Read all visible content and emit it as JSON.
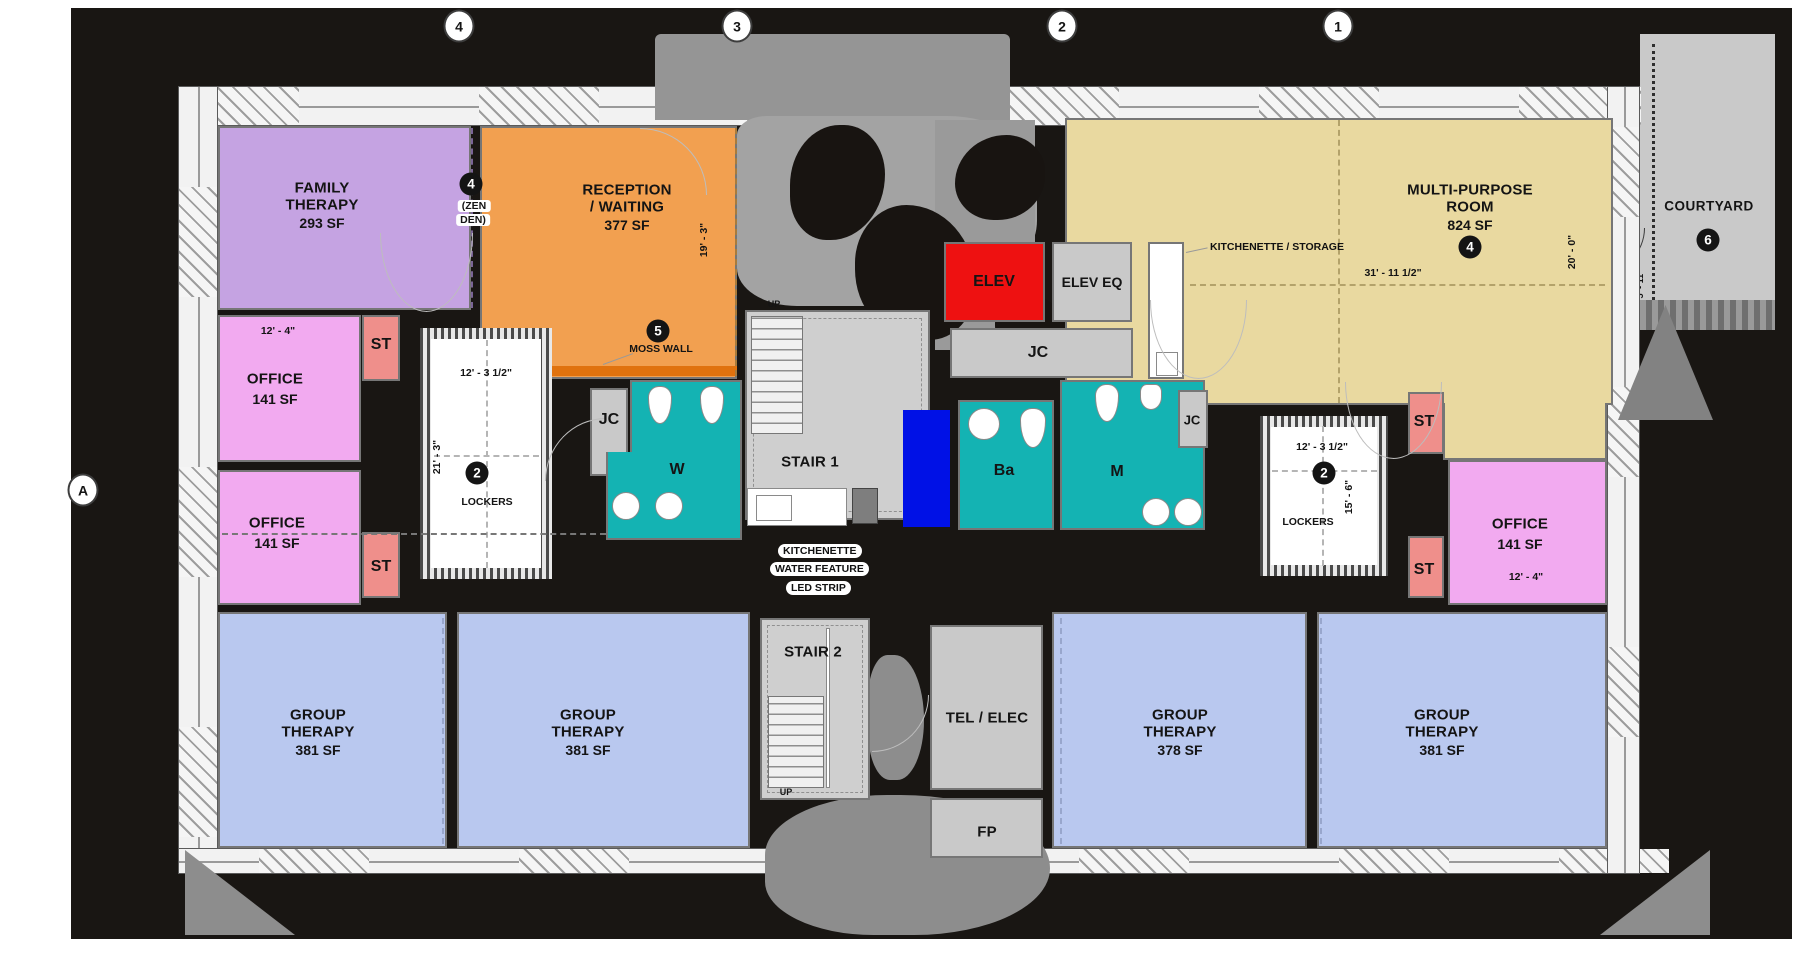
{
  "grid_markers": {
    "top": [
      "4",
      "3",
      "2",
      "1"
    ],
    "side": [
      "A"
    ]
  },
  "rooms": {
    "family_therapy": {
      "line1": "FAMILY",
      "line2": "THERAPY",
      "area": "293 SF"
    },
    "reception": {
      "line1": "RECEPTION",
      "line2": "/ WAITING",
      "area": "377 SF"
    },
    "multi_purpose": {
      "line1": "MULTI-PURPOSE",
      "line2": "ROOM",
      "area": "824 SF",
      "keynote": "4"
    },
    "courtyard": {
      "label": "COURTYARD",
      "keynote": "6"
    },
    "office_nw": {
      "label": "OFFICE",
      "area": "141 SF"
    },
    "office_sw": {
      "label": "OFFICE",
      "area": "141 SF"
    },
    "office_e": {
      "label": "OFFICE",
      "area": "141 SF"
    },
    "group_therapy_1": {
      "line1": "GROUP",
      "line2": "THERAPY",
      "area": "381 SF"
    },
    "group_therapy_2": {
      "line1": "GROUP",
      "line2": "THERAPY",
      "area": "381 SF"
    },
    "group_therapy_3": {
      "line1": "GROUP",
      "line2": "THERAPY",
      "area": "378 SF"
    },
    "group_therapy_4": {
      "line1": "GROUP",
      "line2": "THERAPY",
      "area": "381 SF"
    },
    "stair1": {
      "label": "STAIR 1",
      "up": "UP"
    },
    "stair2": {
      "label": "STAIR 2",
      "up": "UP"
    },
    "elev": {
      "label": "ELEV"
    },
    "elev_eq": {
      "label": "ELEV EQ"
    },
    "tel_elec": {
      "label": "TEL / ELEC"
    },
    "fp": {
      "label": "FP"
    },
    "restroom_w": {
      "label": "W"
    },
    "restroom_m": {
      "label": "M"
    },
    "restroom_ba": {
      "label": "Ba"
    },
    "jc_west": {
      "label": "JC"
    },
    "jc_center": {
      "label": "JC"
    },
    "jc_east": {
      "label": "JC"
    },
    "st_nw": {
      "label": "ST"
    },
    "st_sw": {
      "label": "ST"
    },
    "st_ne": {
      "label": "ST"
    },
    "st_se": {
      "label": "ST"
    },
    "lockers_west": {
      "label": "LOCKERS",
      "keynote": "2"
    },
    "lockers_east": {
      "label": "LOCKERS",
      "keynote": "2"
    }
  },
  "keynotes": {
    "zen_den": {
      "num": "4",
      "line1": "(ZEN",
      "line2": "DEN)"
    },
    "moss_wall": {
      "num": "5",
      "label": "MOSS WALL"
    }
  },
  "callouts": {
    "kitchenette_storage": "KITCHENETTE / STORAGE",
    "kitchenette": "KITCHENETTE",
    "water_feature": "WATER FEATURE",
    "led_strip": "LED STRIP"
  },
  "dimensions": {
    "office_nw_w": "12' - 4\"",
    "office_e_w": "12' - 4\"",
    "lockers_west_w": "12' - 3 1/2\"",
    "lockers_west_h": "21' - 3\"",
    "lockers_east_w": "12' - 3 1/2\"",
    "lockers_east_h": "15' - 6\"",
    "reception_h": "19' - 3\"",
    "multi_purpose_w": "31' - 11 1/2\"",
    "multi_purpose_h": "20' - 0\"",
    "courtyard_path": "5' - 11\""
  },
  "colors": {
    "family_therapy": "#c5a3e2",
    "reception": "#f2a050",
    "multi_purpose": "#e9d9a0",
    "office": "#f2aaf0",
    "group_therapy": "#b9c8ef",
    "storage": "#ef8f8b",
    "restroom": "#14b3b3",
    "elevator": "#ee1111",
    "water_feature": "#0011e6",
    "courtyard": "#c9c9c9"
  }
}
